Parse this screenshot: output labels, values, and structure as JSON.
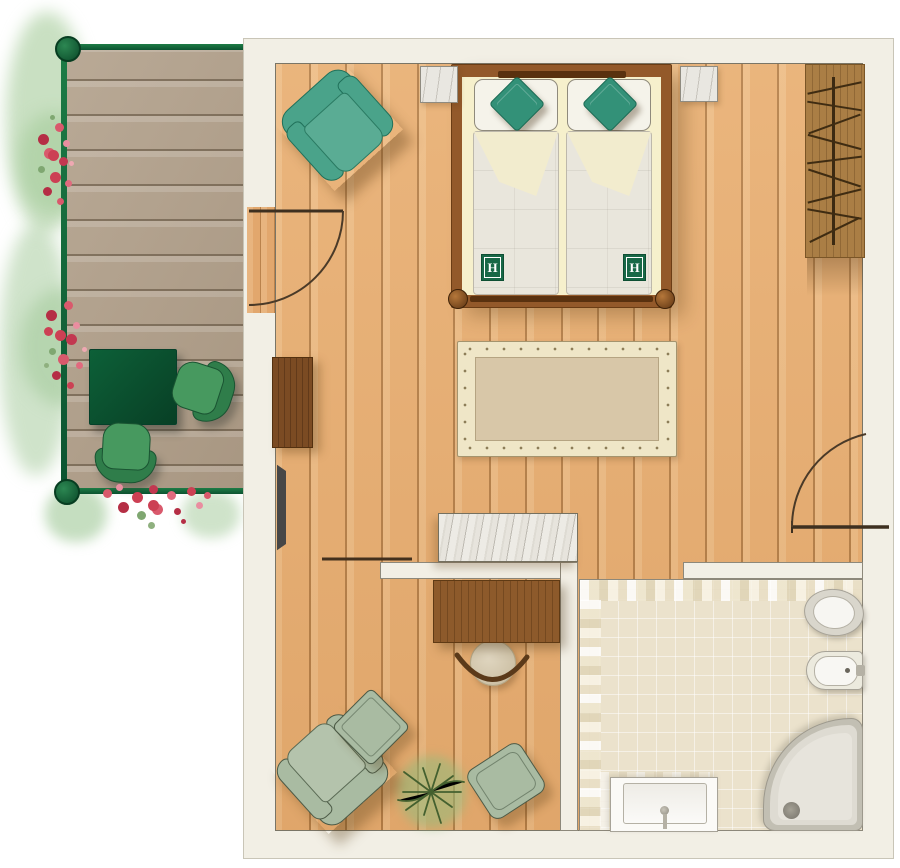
{
  "plan": {
    "monogram": "H",
    "areas": [
      "balcony-deck",
      "bedroom",
      "sitting-area",
      "bathroom",
      "entry"
    ],
    "furniture": {
      "balcony": [
        "table",
        "chair",
        "chair",
        "geranium-flowers",
        "railing"
      ],
      "bedroom": [
        "double-bed",
        "pillows",
        "teal-cushions",
        "nightstand-left",
        "nightstand-right",
        "teal-armchair",
        "wardrobe-with-hangers",
        "rug",
        "dresser",
        "wall-panel",
        "marble-counter",
        "balcony-door",
        "entry-door"
      ],
      "sitting": [
        "desk",
        "desk-chair",
        "sage-armchair",
        "ottoman",
        "floor-cushion",
        "potted-plant",
        "sliding-door"
      ],
      "bathroom": [
        "toilet",
        "bidet",
        "corner-shower",
        "washbasin"
      ]
    },
    "colors": {
      "wall": "#f2efe5",
      "floor_wood": "#e8ae72",
      "deck_wood": "#b3a28d",
      "railing_green": "#13713f",
      "table_green": "#0a5633",
      "teal": "#4aa38a",
      "sage": "#a9bba2",
      "tile": "#ebe2cc",
      "logo_green": "#186847",
      "marble": "#e9e7e1",
      "furniture_wood": "#8d5a2b"
    }
  }
}
